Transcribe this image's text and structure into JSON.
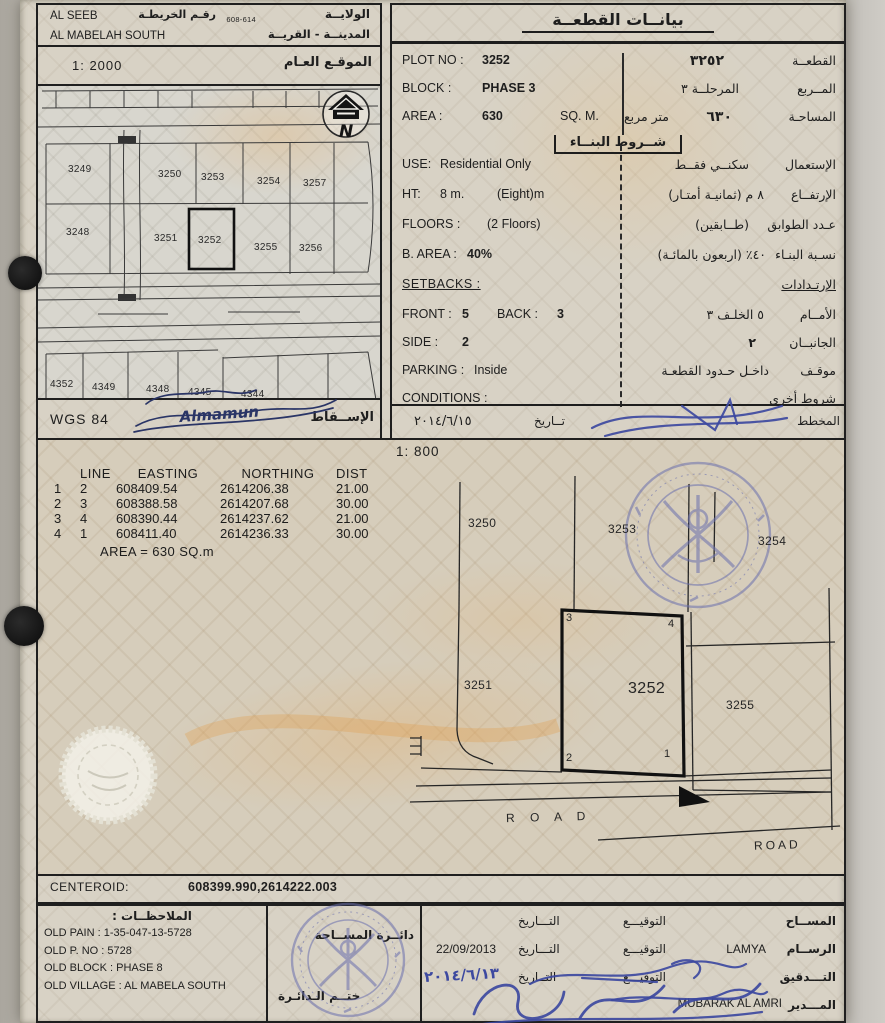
{
  "colors": {
    "ink_blue": "#3d49a0",
    "stamp_blue": "#6a6fae",
    "watermark_orange": "#e0a75e",
    "paper": "#d8d2c5"
  },
  "header": {
    "wilaya_en": "AL SEEB",
    "wilaya_ar": "الولايــة",
    "mapno_ar": "رقـم الخريطـة",
    "mapno": "608-614",
    "village_en": "AL MABELAH SOUTH",
    "village_ar": "المدينــة - القريــة"
  },
  "overview_map": {
    "scale": "1: 2000",
    "title_ar": "الموقـع العـام",
    "north": "N",
    "row_upper": [
      "3249",
      "3250",
      "3253",
      "3254",
      "3257"
    ],
    "row_lower": [
      "3248",
      "3251",
      "3252",
      "3255",
      "3256"
    ],
    "row_bottom": [
      "4352",
      "4349",
      "4348",
      "4345",
      "4344"
    ]
  },
  "projection": {
    "datum": "WGS 84",
    "signature": "Almamun",
    "label_ar": "الإســقاط"
  },
  "plot_data": {
    "title_ar": "بيانــات القطعــة",
    "plot_no": {
      "en_label": "PLOT NO :",
      "en_value": "3252",
      "ar_value": "٣٢٥٢",
      "ar_label": "القطعــة"
    },
    "block": {
      "en_label": "BLOCK :",
      "en_value": "PHASE 3",
      "ar_value": "المرحلــة ٣",
      "ar_label": "المــربع"
    },
    "area": {
      "en_label": "AREA :",
      "en_value": "630",
      "en_unit": "SQ. M.",
      "ar_unit": "متر مربع",
      "ar_value": "٦٣٠",
      "ar_label": "المساحـة"
    },
    "conditions_title_ar": "شــروط البنــاء",
    "use": {
      "en_label": "USE:",
      "en_value": "Residential Only",
      "ar_value": "سكنــي فقــط",
      "ar_label": "الإستعمال"
    },
    "ht": {
      "en_label": "HT:",
      "en_value": "8 m.",
      "en_note": "(Eight)m",
      "ar_value": "٨ م (ثمانيـة أمتـار)",
      "ar_label": "الإرتفــاع"
    },
    "floors": {
      "en_label": "FLOORS :",
      "en_value": "(2 Floors)",
      "ar_value": "(طــابقين)",
      "ar_label": "عـدد الطوابق"
    },
    "barea": {
      "en_label": "B. AREA :",
      "en_value": "40%",
      "ar_value": "٤٠٪ (اربعون بالمائـة)",
      "ar_label": "نسـبة البنـاء"
    },
    "setbacks_en": "SETBACKS :",
    "setbacks_ar": "الإرتـدادات",
    "front": {
      "en_label": "FRONT :",
      "en_value": "5",
      "back_label": "BACK :",
      "back_value": "3",
      "ar_value": "٥ الخلـف ٣",
      "ar_label": "الأمــام"
    },
    "side": {
      "en_label": "SIDE :",
      "en_value": "2",
      "ar_value": "٢",
      "ar_label": "الجانبــان"
    },
    "parking": {
      "en_label": "PARKING :",
      "en_value": "Inside",
      "ar_value": "داخـل حـدود القطعـة",
      "ar_label": "موقـف"
    },
    "conditions": {
      "en_label": "CONDITIONS :",
      "ar_label": "شروط أخرى"
    },
    "date_row": {
      "date": "٢٠١٤/٦/١٥",
      "date_label": "تــاريخ",
      "planner_label": "المخطط"
    }
  },
  "coords_table": {
    "headers": {
      "line": "LINE",
      "easting": "EASTING",
      "northing": "NORTHING",
      "dist": "DIST"
    },
    "rows": [
      {
        "a": "1",
        "b": "2",
        "e": "608409.54",
        "n": "2614206.38",
        "d": "21.00"
      },
      {
        "a": "2",
        "b": "3",
        "e": "608388.58",
        "n": "2614207.68",
        "d": "30.00"
      },
      {
        "a": "3",
        "b": "4",
        "e": "608390.44",
        "n": "2614237.62",
        "d": "21.00"
      },
      {
        "a": "4",
        "b": "1",
        "e": "608411.40",
        "n": "2614236.33",
        "d": "30.00"
      }
    ],
    "area": "AREA = 630  SQ.m"
  },
  "main_map": {
    "scale": "1: 800",
    "p3250": "3250",
    "p3253": "3253",
    "p3254": "3254",
    "p3251": "3251",
    "p3252": "3252",
    "p3255": "3255",
    "c1": "1",
    "c2": "2",
    "c3": "3",
    "c4": "4",
    "road1": "R O A D",
    "road2": "ROAD"
  },
  "centeroid": {
    "label": "CENTEROID:",
    "value": "608399.990,2614222.003"
  },
  "notes": {
    "title_ar": "الملاحظــات :",
    "lines": [
      "OLD PAIN : 1-35-047-13-5728",
      "OLD P. NO : 5728",
      "OLD BLOCK : PHASE 8",
      "OLD VILLAGE : AL MABELA SOUTH"
    ]
  },
  "stamp_box": {
    "line1_ar": "دائــرة المســاحة",
    "line2_ar": "ختــم الـدائـرة"
  },
  "signoff": {
    "rows": [
      {
        "role": "المســاح",
        "name": "",
        "sig": "التوقيـــع",
        "datelbl": "التـــاريخ",
        "date": ""
      },
      {
        "role": "الرســام",
        "name": "LAMYA",
        "sig": "التوقيـــع",
        "datelbl": "التـــاريخ",
        "date": "22/09/2013"
      },
      {
        "role": "التـــدقيق",
        "name": "",
        "sig": "التوقيـــع",
        "datelbl": "التــاريخ",
        "date": "٢٠١٤/٦/١٣"
      },
      {
        "role": "المـــدير",
        "name": "MUBARAK AL AMRI",
        "sig": "",
        "datelbl": "",
        "date": ""
      }
    ]
  }
}
